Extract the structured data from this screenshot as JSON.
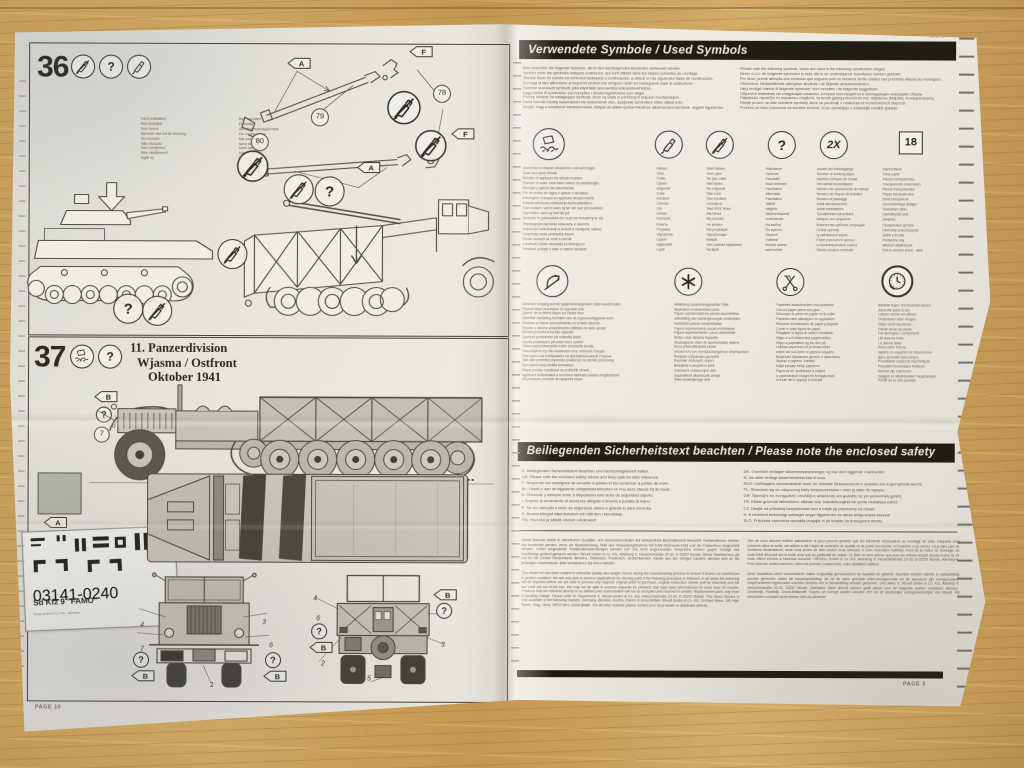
{
  "kit": {
    "code_left": "03141",
    "code_right": "03141"
  },
  "pages": {
    "left_label": "PAGE 10",
    "right_label": "PAGE 3"
  },
  "icons": {
    "question": "?",
    "multiply": "2X",
    "clear_parts": "18"
  },
  "step36": {
    "number": "36",
    "parts": {
      "p78": "78",
      "p79": "79",
      "p80": "80"
    },
    "flags": {
      "a": "A",
      "f": "F"
    },
    "not_included_col1": [
      "Nicht enthalten",
      "Not included",
      "Non fourni",
      "Behoort niet tot de levering",
      "No incluido",
      "Não incluído",
      "Non compreso",
      "Ikke medleveret",
      "Ingår ej"
    ],
    "not_included_col2": [
      "Ikke inkludert",
      "Ei sisälly",
      "Δεν συμπεριλαμβάνεται",
      "Не содержится",
      "Nie zawarte",
      "Nem tartalmazza",
      "Není obsaženo",
      "İçinde yoktur",
      "Ni vsebovano"
    ]
  },
  "step37": {
    "number": "37",
    "title1": "11. Panzerdivision",
    "title2": "Wjasma / Ostfront",
    "title3": "Oktober 1941",
    "flags": {
      "a": "A",
      "b": "B"
    },
    "side_nums": {
      "n6": "6",
      "n7": "7"
    },
    "front_nums": {
      "n1": "1",
      "n3": "3",
      "n4": "4",
      "n6": "6",
      "n7": "7"
    },
    "rear_nums": {
      "n2": "2",
      "n3": "3",
      "n4": "4",
      "n5": "5",
      "n6": "6",
      "n9": "9"
    },
    "decal_sheet": {
      "code": "03141-0240",
      "name": "Sd Kfz 9 \"FAMO\"",
      "footnote": "Revell GmbH & Co. KG · Germany"
    }
  },
  "legend": {
    "header": "Verwendete Symbole / Used Symbols",
    "intro_col1": [
      "Bitte beachten Sie folgende Symbole, die in den nachfolgenden Baustufen verwendet werden.",
      "Veuillez noter les symboles indiqués ci-dessous, qui sont utilisés dans les étapes suivantes du montage.",
      "Sírvase tener en cuenta los símbolos facilitados a continuación, a utilizar en las siguientes fases de construcción.",
      "Si prega di fare attenzione ai seguenti simboli che vengono usati nei susseguenti stadi di costruzione.",
      "Huomioi seuraavat symbolit, joita käytetään seuraavissa kokoamisvaiheissa.",
      "Legg merke til symbolene som benyttes i monteringstrinnene som følger.",
      "Proszę zważać na następujące symbole, które są użyte w poniższych etapach montażowych.",
      "Daha sonraki montaj basamaklarında kullanılacak olan, aşağıdaki sembollere lütfen dikkat edin.",
      "Kérjük, hogy a következő szimbólumokat, melyek az alábbi építési fokokban alkalmazásra kerülnek, vegyék figyelembe."
    ],
    "intro_col2": [
      "Please note the following symbols, which are used in the following construction stages.",
      "Neem a.u.b. de volgende symbolen in acht, die in de onderstaande bouwfasen worden gebruikt.",
      "Por favor, preste atenção aos símbolos que seguem pois os mesmos serão usados nas próximas etapas de montagem.",
      "Observera: Nedanstående piktogram används i de följande arbetsmomenten.",
      "Læg venligst mærke til følgende symboler, som benyttes i de følgende byggefaser.",
      "Обратите внимание на следующие символы, которые используются в последующих операциях сборки.",
      "Παρακαλώ προσέξτε τα παρακάτω σύμβολα, τα οποία χρησιμοποιούνται στις παρακάτω βαθμίδες συναρμολόγησης.",
      "Dbejte prosím na dále uvedené symboly, které se používají v následujících konstrukčních stupních.",
      "Prosimo za Vašo pozornost na sledeče simbole, ki se uporabljajo v naslednjih korakih gradnje."
    ],
    "columns": [
      {
        "name": "decal-soak",
        "lines": [
          "Abziehbild in Wasser einweichen und anbringen",
          "Soak and apply decals",
          "Mouiller et appliquer les décalcomanies",
          "Transfer in water even laten weken en aanbrengen",
          "Remojar y aplicar las calcomanías",
          "Pôr de molho em água e aplicar o decalque",
          "Immergere in acqua ed applicare decalcomanie",
          "Kostuta siirtokuva vedessä ja aseta paikalleen",
          "Fukt motivet i varmt vann og før det over på modellen",
          "Dyp bildet i vann og sett det på",
          "Διαλύστε τη χαλκομανία στο νερό και τοποθετήστε την",
          "Переводную картинку намочить и нанести",
          "Zmiękczyć kalkomanię w wodzie a następnie nakleić",
          "Çıkartmayı suda yumuşatıp koyun",
          "Obtisk namočit ve vodě a umístit",
          "a matricát vízben beáztatni és felhelyezni",
          "Preslikač potopiti v vodo in zatem nanašati"
        ]
      },
      {
        "name": "glue",
        "lines": [
          "Kleben",
          "Glue",
          "Coller",
          "Lijmen",
          "Engomar",
          "Colar",
          "Incollare",
          "Limmas",
          "Lim",
          "Liimaa",
          "Κολλήστε",
          "Клеить",
          "Przykleić",
          "Yapıştırma",
          "Lepení",
          "ragasztani",
          "Lepiti"
        ]
      },
      {
        "name": "no-glue",
        "lines": [
          "Nicht kleben",
          "Don't glue",
          "Ne pas coller",
          "Niet lijmen",
          "No engomar",
          "Não colar",
          "Non incollare",
          "Limmas ej",
          "Skal IKKE limes",
          "Älä liimaa",
          "Μη κολλάτε",
          "Не клеить",
          "Nie przyklejać",
          "Yapıştırmayın",
          "Nelepit",
          "nem szabad ragasztani",
          "Ne lepiti"
        ]
      },
      {
        "name": "optional",
        "lines": [
          "Wahlweise",
          "Optional",
          "Facultatif",
          "Naar believen",
          "Facultativo",
          "Alternado",
          "Facoltativo",
          "Valfritt",
          "Valgfritt",
          "Vaihtoehtoisesti",
          "εναλλακτικά",
          "На выбор",
          "Do wyboru",
          "Seçmeli",
          "Volitelně",
          "tetszés szerint",
          "način izbire"
        ]
      },
      {
        "name": "number-of-steps",
        "lines": [
          "Anzahl der Arbeitsgänge",
          "Number of working steps",
          "Nombre d'étapes de travail",
          "Het aantal bouwstappen",
          "Número de operaciones de trabajo",
          "Número de etapas de trabalho",
          "Numero di passaggi",
          "Antal arbetsmoment",
          "Antall arbeidstrinn",
          "Työvaiheiden lukumäärä",
          "αριθμός των εργασιών",
          "Количество рабочих операций",
          "Liczba operacji",
          "İş safhalarının sayısı",
          "Počet pracovních operací",
          "a munkafolyamatok száma",
          "Število korakov montaže"
        ]
      },
      {
        "name": "clear-parts",
        "lines": [
          "Klarsichtteile",
          "Clear parts",
          "Pièces transparentes",
          "Transparante onderdelen",
          "Piezas transparentes",
          "Peças transparentes",
          "Parti transparenti",
          "Genomskinliga detaljer",
          "Glassklare deler",
          "Läpinäkyvät osat",
          "Διαφανή",
          "Прозрачные детали",
          "Elementy przezroczyste",
          "Şeffaf parçalar",
          "Průhledné díly",
          "áttetsző alkatrészek",
          "Deli iz umetne snovi - vidni"
        ]
      }
    ],
    "columns2": [
      {
        "name": "repeat-opposite-side",
        "lines": [
          "Gleichen Vorgang auf der gegenüberliegenden Seite wiederholen",
          "Repeat same procedure on opposite side",
          "Opérer de la même façon sur l'autre face",
          "Dezelfde handeling herhalen aan de tegenoverliggende kant",
          "Realizar el mismo procedimiento en el lado opuesto",
          "Repetir o mesmo procedimento utilizado no lado oposto",
          "Stessa procedura sul lato opposto",
          "Upprepa proceduren på motsatta sidan",
          "Gjenta prosedyren på siden tvers overfor",
          "Toista sama toimenpide kuten viereisellä sivulla",
          "επαναλάβετε την ίδια διαδικασία στην απέναντι πλευρά",
          "Повторять как изображено на противоположной стороне",
          "Taki sam przebieg czynności powtórzyć na stronie przeciwnej",
          "Aynı işlemi karşı tarafta tekrarlayın",
          "Stejný postup zopakovat na protilehlé straně",
          "ugyanazt a folyamatot a szemben található oldalon megismételni",
          "Isti postopek ponoviti na nasprotni strani"
        ]
      },
      {
        "name": "assembled-parts-illustration",
        "lines": [
          "Abbildung zusammengesetzter Teile",
          "Illustration of assembled parts",
          "Figure représentant les pièces assemblées",
          "Afbeelding van samengevoegde onderdelen",
          "Ilustración piezas ensambladas",
          "Figura representando peças encaixadas",
          "Figura rappresentante i pezzi assemblati",
          "Bilden visar delarna hopsatta",
          "Illustrasjonen viser de sammensatte delene",
          "Kuva yhteenliitetyistä osista",
          "απεικόνιση των συναρμολογημένων εξαρτημάτων",
          "Рисунок собранных деталей",
          "Rysunek złożonych części",
          "Birleştirilen parçaların şekli",
          "Zobrazení sestavených dílů",
          "összeállított alkatrészek ábrája",
          "Slika sestavljenega dela"
        ]
      },
      {
        "name": "cut-out-paper",
        "lines": [
          "Papierteil ausschneiden und ankleben",
          "Cut out paper piece and glue",
          "Découper la pièce en papier et la coller",
          "Papieren deel uitknippen en opplakken",
          "Recortar la ilustración de papel y pegarla",
          "Cortar e colar figura de papel",
          "Ritagliare la figura di carta e incollarla",
          "Klipp ut och klistra fast pappersbiten",
          "Klipp ut papirdelen og lim den på",
          "Leikkaa paperiosa irti ja liimaa kiinni",
          "κόψτε και κολλήστε το χάρτινο κομμάτι",
          "Вырезать бумажную деталь и приклеить",
          "Wyciąć z papieru i nakleić",
          "Kağıt parçayı kesip yapıştırın",
          "Papírový díl vystřihnout a nalepit",
          "a papírdarabot kivágni és felragasztani",
          "Izrezati del iz papirja in nalepiti"
        ]
      },
      {
        "name": "drying-time",
        "lines": [
          "Beiseite legen und trocknen lassen",
          "Allow the parts to dry",
          "Laisser sécher les pièces",
          "Onderdelen laten drogen",
          "Dejar secar las piezas",
          "Deixar secar as peças",
          "Far asciugare i componenti",
          "Låt delarna torka",
          "La delene tørke",
          "Anna osien kuivua",
          "αφήστε τα κομμάτια να στεγνώσουν",
          "Дать деталям просохнуть",
          "Pozostawić części do wyschnięcia",
          "Parçaların kurumasını bekleyin",
          "Nechat díly zaschnout",
          "hagyjuk az alkatrészeket megszáradni",
          "Pustiti da se deli posušijo"
        ]
      }
    ]
  },
  "safety": {
    "header": "Beiliegenden Sicherheitstext beachten / Please note the enclosed safety advice",
    "col1": [
      "D: Beiliegenden Sicherheitstext beachten und nachschlagebereit halten.",
      "GB: Please note the enclosed safety advice and keep safe for later reference.",
      "F: Respecter les consignes de sécurité ci-jointes et les conserver à portée de main.",
      "NL: Houdt u aan de bijgaande veiligheidsinstructies en hou deze steeds bij de hand.",
      "E: Observar y siempre tener a disposición este texto de seguridad adjunto.",
      "I: Seguire le avvertenze di sicurezza allegate e tenerle a portata di mano.",
      "P: Ter em atenção o texto de segurança anexo e guardá-lo para consulta.",
      "S: Beakta bifogad säkerhetstext och håll den i beredskap.",
      "FIN: Huomioi ja säilytä oheiset varoitukset."
    ],
    "col2": [
      "DK: Overhold vedlagte sikkerhedsanvisninger og hav dem liggende i nærheden.",
      "N: Ha alltid vedlagt sikkerhetstekst klar til bruk.",
      "RUS: Соблюдать прилагаемый текст по технике безопасности и хранить его в доступном месте.",
      "PL: Stosować się do załączonej karty bezpieczeństwa i mieć ją stale do wglądu.",
      "GR: Προσέξτε τις συνημμένες υποδείξεις ασφάλειας και φυλάξτε τις για μελλοντική χρήση.",
      "TR: Ekteki güvenlik talimatlarını dikkate alıp, bakabileceğiniz bir yerde muhafaza ediniz.",
      "CZ: Dbejte na přiložený bezpečnostní text a mějte jej připravený na dosah.",
      "H: A mellékelt biztonsági szöveget vegye figyelembe és tartsa fellapozásra készen!",
      "SLO: Priložena varnostna navodila izvajajte in jih hranite na dostopnem mestu."
    ]
  },
  "legal": {
    "col1_p1": "Dieser Bausatz wurde in mehrfachen Qualitäts- und Gewichtskontrollen auf einwandfreie Beschaffenheit überprüft. Reklamationen können nur bearbeitet werden, wenn die Beanstandung, Teile des Verpackungskartons mit EAN-Strichcode-Feld und der Kassenbon eingereicht werden. Unfrei eingesandte Reklamationssendungen werden von uns nicht angenommen. Ansprüche können gegen Vorlage des Kaufbelegs geltend gemacht werden: Revell GmbH & Co. KG, Abteilung X, Henschelstraße 20-30, D-32257 Bünde. Dieser Direktservice gilt nur für die Länder Deutschland, Benelux, Österreich, Frankreich, Großbritannien. Käufer aus den übrigen Ländern wenden sich an die jeweiligen Distributeure. Bitte kontaktieren Sie Ihren Händler.",
    "col1_p2": "This Model Kit has been subject to extensive quality and weight checks during the manufacturing process to ensure it leaves our warehouse in perfect condition. We are only able to process applications for missing parts if the following procedure is followed. In all cases the following will be required before we are able to process any request: original proof of purchase, original instruction sheets (will be returned) and the bar code cut out of the box. We may not be able to process requests for products that have been discontinued for more than 24 months. Products that are returned directly to us without prior authorisation will not be accepted and returned to sender. Replacement parts may incur a handling charge. Please write to: Department X, Revell GmbH & Co. KG, Henschelstraße 20-30, D-32257 Bünde. This direct Service is only available in the following markets: Germany, Benelux, Austria, France & Great Britain. Revell GmbH & Co. KG, Orchard Mews, 18c High Street, Tring, Herts. HP23 5AH, Great Britain. For all other markets please contact your local dealer or distributor directly.",
    "col2_p1": "Afin de vous assurer entière satisfaction et pour pouvoir garantir que les éléments nécessaires au montage de cette maquette sont présents dans la boîte, cet article a fait l'objet de contrôles de qualité et de poids successifs. Si toutefois vous deviez nous faire part de certaines réclamations, nous vous prions de bien vouloir vous adresser à votre revendeur habituel, muni de la notice de montage, du code EAN découpé sur la boîte ainsi que du justificatif de caisse. Le SAV ne sera assuré que pour les articles acquis depuis moins de 24 mois. Merci d'écrire à l'adresse suivante : REVELL GmbH & Co. KG, Abteilung X, Henschelstraße 20-30, D-32257 Bünde, Allemagne. Pour tous les autres marchés, merci de prendre contact avec votre détaillant habituel.",
    "col2_p2": "Deze bouwdoos werd verscheidene malen zorgvuldig gecontroleerd op kwaliteit en gewicht. Klachten kunnen slechts in behandeling worden genomen indien de bouwhandleiding, de uit de doos geknipte EAN-streepjescode en de kassabon zijn meegezonden. Ongefrankeerd ingezonden klachten kunnen niet in behandeling worden genomen. Ons adres is: Revell GmbH & Co. KG, Afdeling X, Henschelstraße 20-30, 32257 Bünde, Duitsland. Deze directe service geldt alleen voor de volgende landen: Duitsland, Benelux, Oostenrijk, Frankrijk, Groot-Brittannië. Kopers uit overige landen wenden zich tot de plaatselijke vertegenwoordiger van Revell. Wij verzoeken u contact op te nemen met uw winkelier."
  }
}
